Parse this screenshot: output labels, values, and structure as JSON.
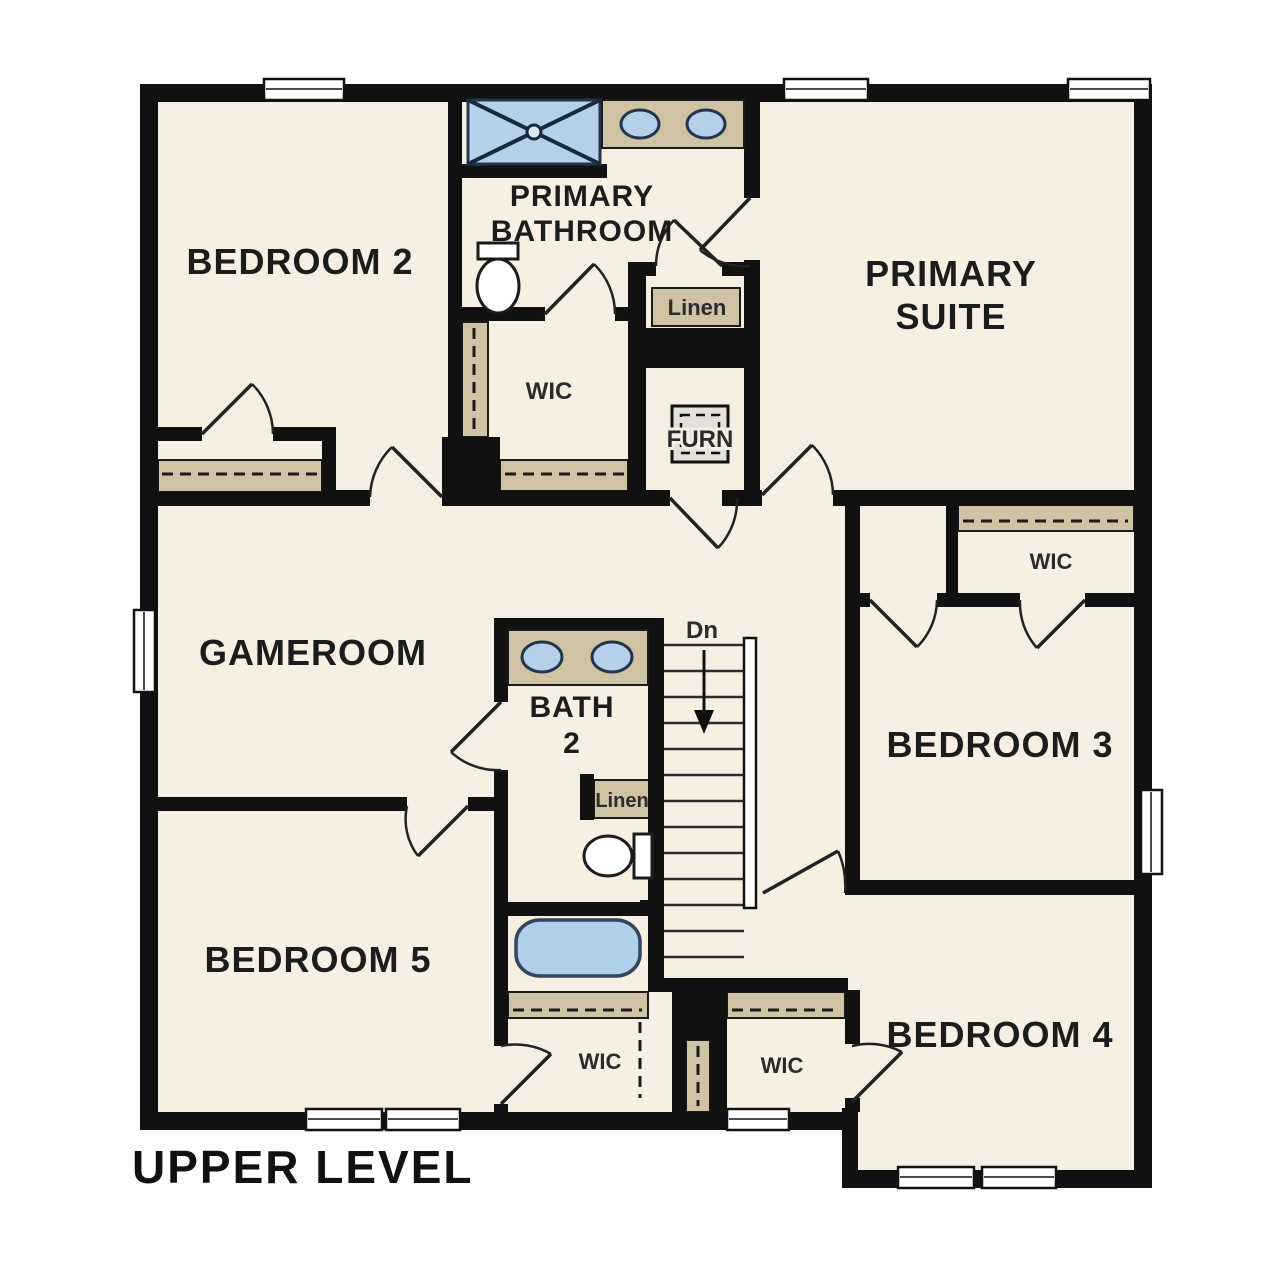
{
  "page_title": "UPPER LEVEL",
  "rooms": {
    "bedroom_2": "BEDROOM 2",
    "primary_bathroom": [
      "PRIMARY",
      "BATHROOM"
    ],
    "primary_suite": [
      "PRIMARY",
      "SUITE"
    ],
    "gameroom": "GAMEROOM",
    "bath_2": [
      "BATH",
      "2"
    ],
    "bedroom_3": "BEDROOM 3",
    "bedroom_4": "BEDROOM 4",
    "bedroom_5": "BEDROOM 5"
  },
  "closets": {
    "linen_primary": "Linen",
    "linen_bath2": "Linen",
    "furnace": "FURN",
    "wic_primary": "WIC",
    "wic_bedroom3": "WIC",
    "wic_bedroom5": "WIC",
    "wic_bedroom4": "WIC"
  },
  "stairs": {
    "down_label": "Dn"
  },
  "fixtures": [
    "walk-in-shower",
    "primary-vanity-two-sinks",
    "primary-toilet",
    "bath2-vanity-two-sinks",
    "bath2-toilet",
    "bathtub",
    "staircase-down",
    "furnace-unit"
  ],
  "colors": {
    "background": "#ffffff",
    "floor": "#f7f0e2",
    "wall": "#111111",
    "casework_tan": "#cfc3a4",
    "fixture_blue": "#b7d0e9",
    "fixture_outline": "#22354a",
    "text": "#1c1c1c"
  }
}
